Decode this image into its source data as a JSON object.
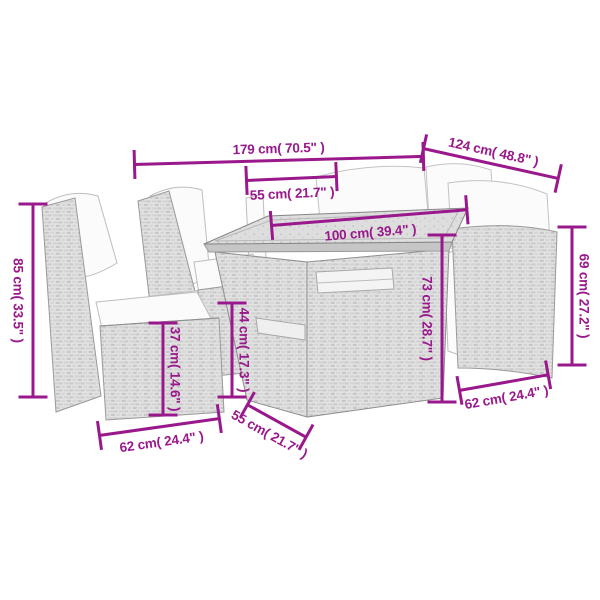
{
  "page": {
    "background": "#ffffff",
    "dimension_color": "#99188b",
    "subject": "garden furniture set dimension diagram"
  },
  "dimensions": [
    {
      "id": "sofa-length",
      "label": "179 cm( 70.5\" )"
    },
    {
      "id": "sofa-depth",
      "label": "124 cm( 48.8\" )"
    },
    {
      "id": "seat-width-top",
      "label": "55 cm( 21.7\" )"
    },
    {
      "id": "table-length",
      "label": "100 cm( 39.4\" )"
    },
    {
      "id": "table-height",
      "label": "73 cm( 28.7\" )"
    },
    {
      "id": "right-chair-height",
      "label": "69 cm( 27.2\" )"
    },
    {
      "id": "left-chair-height",
      "label": "85 cm( 33.5\" )"
    },
    {
      "id": "seat-height",
      "label": "37 cm( 14.6\" )"
    },
    {
      "id": "armrest-height",
      "label": "44 cm( 17.3\" )"
    },
    {
      "id": "left-chair-width",
      "label": "62 cm( 24.4\" )"
    },
    {
      "id": "table-depth",
      "label": "55 cm( 21.7\" )"
    },
    {
      "id": "right-chair-width",
      "label": "62 cm( 24.4\" )"
    }
  ]
}
